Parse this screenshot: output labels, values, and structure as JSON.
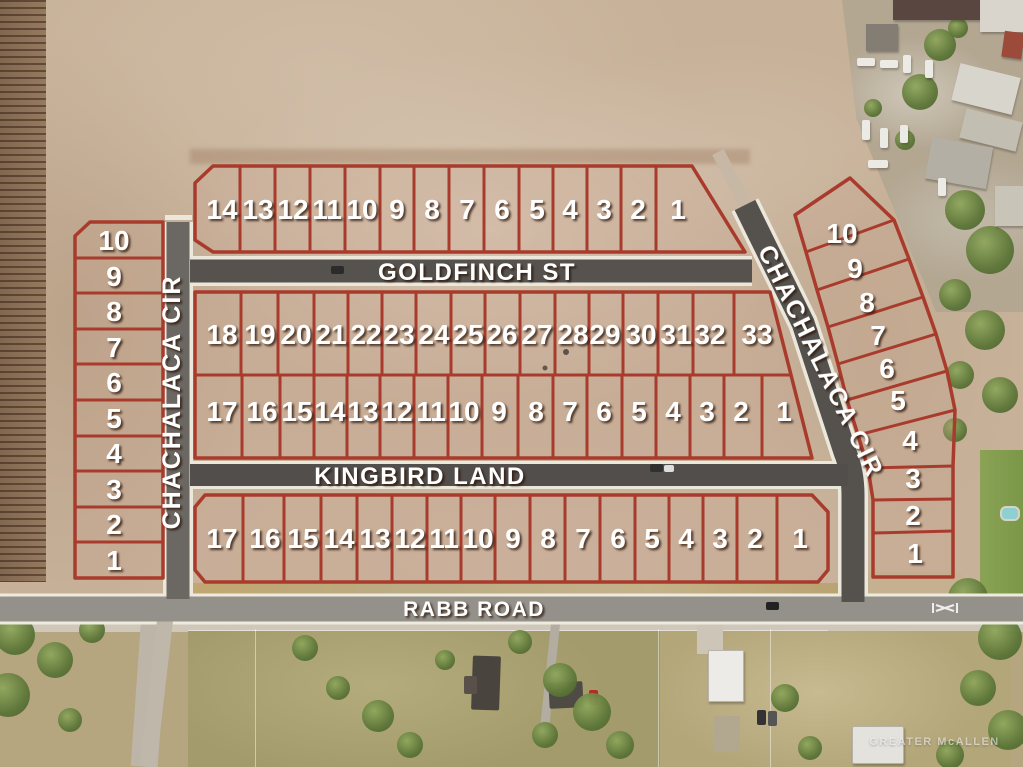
{
  "map": {
    "watermark": "GREATER McALLEN"
  },
  "streets": {
    "goldfinch": "GOLDFINCH ST",
    "kingbird": "KINGBIRD LAND",
    "chachalaca_west": "CHACHALACA CIR",
    "chachalaca_east": "CHACHALACA CIR",
    "rabb": "RABB ROAD"
  },
  "blocks": {
    "north_row": {
      "lots": [
        "14",
        "13",
        "12",
        "11",
        "10",
        "9",
        "8",
        "7",
        "6",
        "5",
        "4",
        "3",
        "2",
        "1"
      ]
    },
    "middle_north_row": {
      "lots": [
        "18",
        "19",
        "20",
        "21",
        "22",
        "23",
        "24",
        "25",
        "26",
        "27",
        "28",
        "29",
        "30",
        "31",
        "32",
        "33"
      ]
    },
    "middle_south_row": {
      "lots": [
        "17",
        "16",
        "15",
        "14",
        "13",
        "12",
        "11",
        "10",
        "9",
        "8",
        "7",
        "6",
        "5",
        "4",
        "3",
        "2",
        "1"
      ]
    },
    "south_row": {
      "lots": [
        "17",
        "16",
        "15",
        "14",
        "13",
        "12",
        "11",
        "10",
        "9",
        "8",
        "7",
        "6",
        "5",
        "4",
        "3",
        "2",
        "1"
      ]
    },
    "west_column": {
      "lots": [
        "10",
        "9",
        "8",
        "7",
        "6",
        "5",
        "4",
        "3",
        "2",
        "1"
      ]
    },
    "east_column": {
      "lots": [
        "10",
        "9",
        "8",
        "7",
        "6",
        "5",
        "4",
        "3",
        "2",
        "1"
      ]
    }
  },
  "colors": {
    "lot_line": "#a93b2d",
    "road_paved": "#56534f",
    "road_paved_light": "#6b6762",
    "road_light": "#94918b",
    "label_text": "#ffffff"
  }
}
